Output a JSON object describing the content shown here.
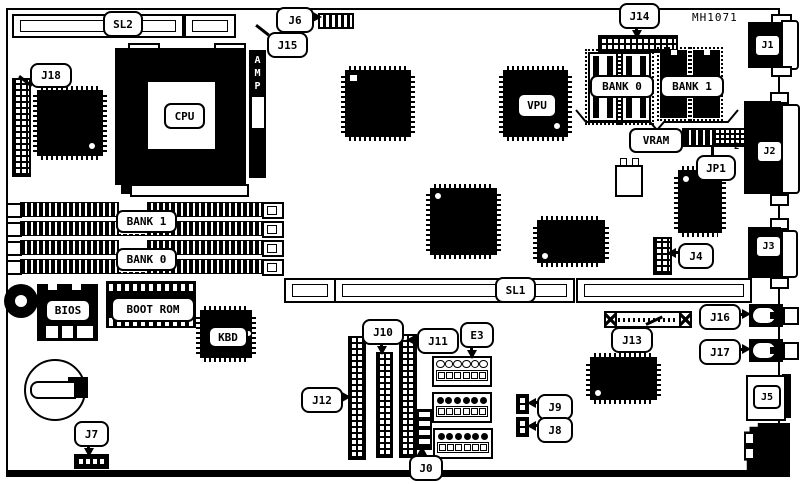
{
  "part_number": "MH1071",
  "slots": {
    "sl1": "SL1",
    "sl2": "SL2"
  },
  "memory": {
    "bank0_simm": "BANK 0",
    "bank1_simm": "BANK 1",
    "bank0_vram": "BANK 0",
    "bank1_vram": "BANK 1",
    "vram": "VRAM"
  },
  "chips": {
    "cpu": "CPU",
    "vpu": "VPU",
    "amp": "AMP",
    "bios": "BIOS",
    "boot_rom": "BOOT ROM",
    "kbd": "KBD"
  },
  "connectors": {
    "j0": "J0",
    "j1": "J1",
    "j2": "J2",
    "j3": "J3",
    "j4": "J4",
    "j5": "J5",
    "j6": "J6",
    "j7": "J7",
    "j8": "J8",
    "j9": "J9",
    "j10": "J10",
    "j11": "J11",
    "j12": "J12",
    "j13": "J13",
    "j14": "J14",
    "j15": "J15",
    "j16": "J16",
    "j17": "J17",
    "j18": "J18",
    "jp1": "JP1",
    "jp1_pin2": "2",
    "e3": "E3"
  }
}
